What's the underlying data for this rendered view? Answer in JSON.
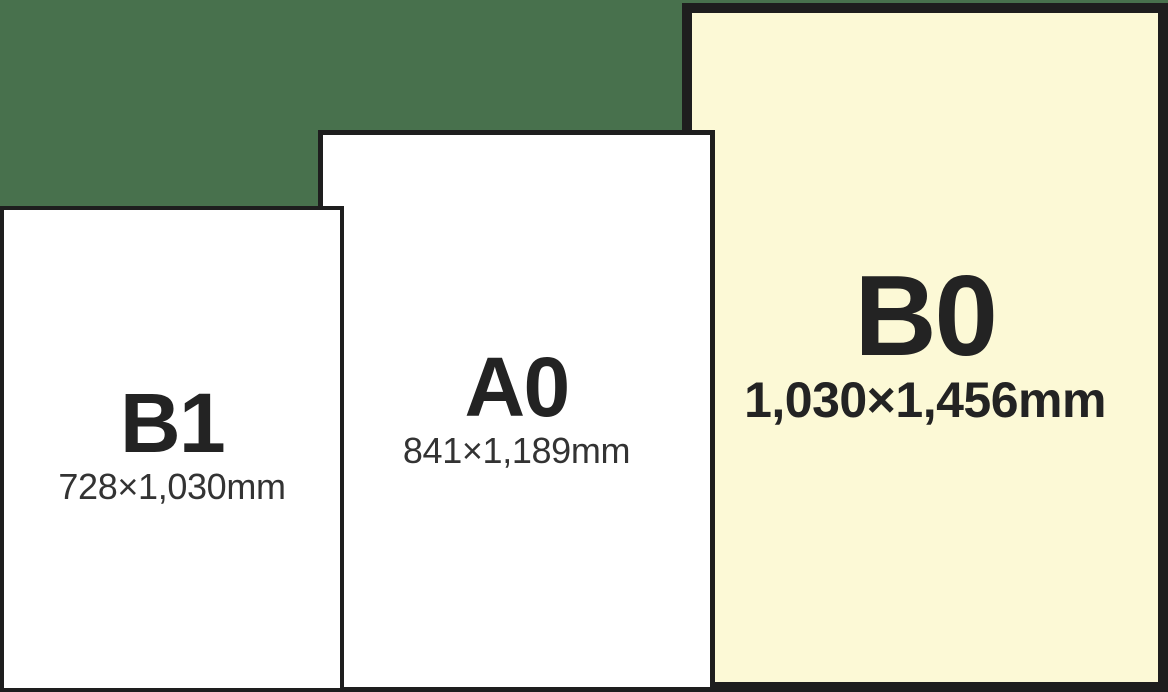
{
  "colors": {
    "background": "#48714D",
    "outline": "#1E1E1E",
    "paper_fill": "#FFFFFF",
    "highlight_fill": "#FCF9D6",
    "text": "#232323"
  },
  "papers": [
    {
      "name": "B1",
      "dimensions": "728×1,030mm",
      "fill": "#FFFFFF",
      "highlighted": false
    },
    {
      "name": "A0",
      "dimensions": "841×1,189mm",
      "fill": "#FFFFFF",
      "highlighted": false
    },
    {
      "name": "B0",
      "dimensions": "1,030×1,456mm",
      "fill": "#FCF9D6",
      "highlighted": true
    }
  ]
}
